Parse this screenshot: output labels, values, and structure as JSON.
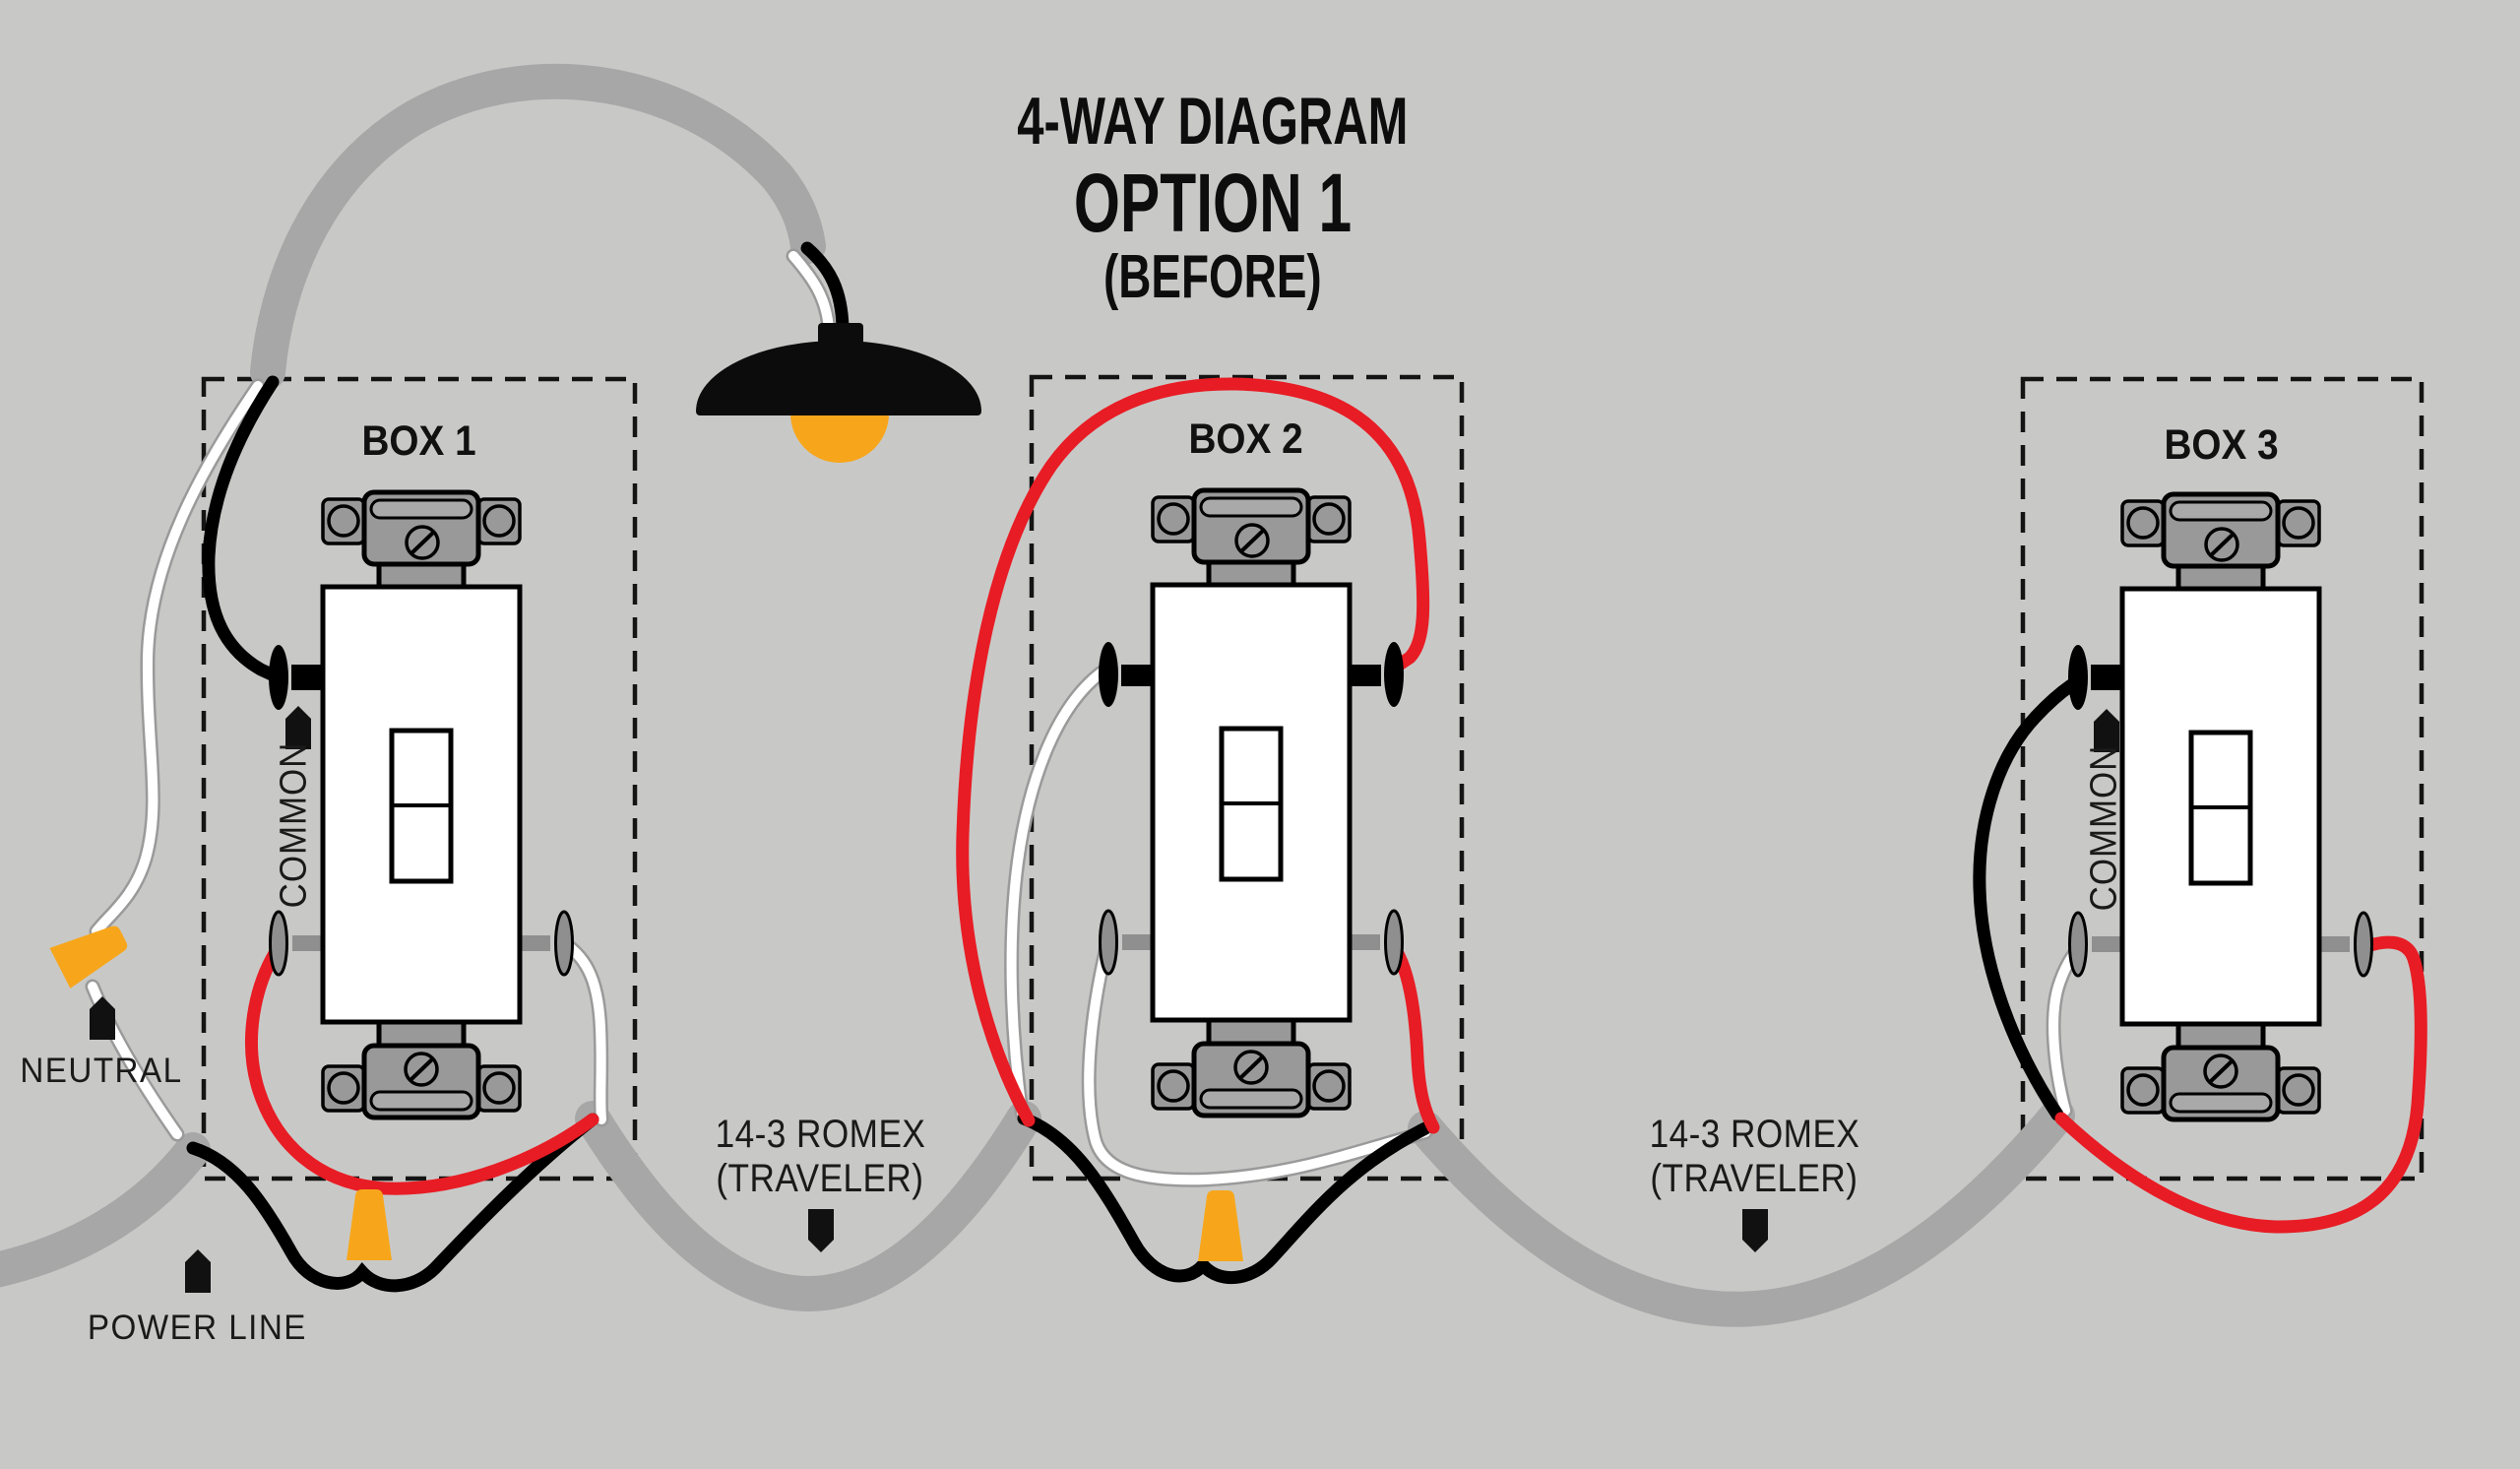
{
  "title": {
    "line1": "4-WAY DIAGRAM",
    "line2": "OPTION 1",
    "line3": "(BEFORE)"
  },
  "boxes": [
    {
      "label": "BOX 1",
      "common_label": "COMMON"
    },
    {
      "label": "BOX 2"
    },
    {
      "label": "BOX 3",
      "common_label": "COMMON"
    }
  ],
  "annotations": {
    "neutral": "NEUTRAL",
    "power_line": "POWER LINE",
    "romex": {
      "line1": "14-3 ROMEX",
      "line2": "(TRAVELER)"
    }
  },
  "colors": {
    "background": "#c8c9c7",
    "hot_wire": "#000000",
    "neutral_wire": "#ffffff",
    "traveler_wire": "#e81c24",
    "cable_sheath": "#a7a7a7",
    "wire_nut": "#f7a61b",
    "switch_metal": "#999999",
    "bulb": "#f7a61b",
    "lamp_shade": "#0c0c0c",
    "text": "#1a1a1a"
  }
}
